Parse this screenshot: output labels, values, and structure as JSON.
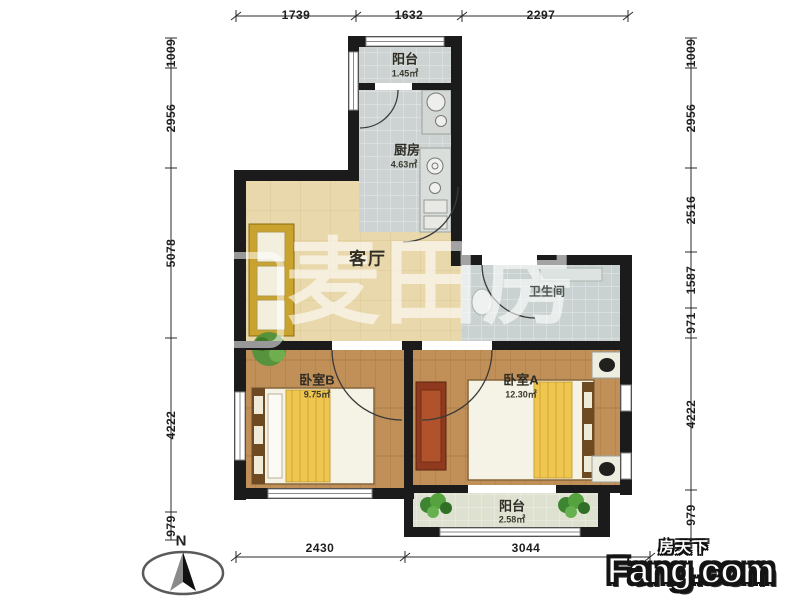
{
  "watermark": {
    "text": "麦田房"
  },
  "compass": {
    "label": "N"
  },
  "logo": {
    "cn": "房天下",
    "en": "Fang.com"
  },
  "rooms": {
    "balcony_top": {
      "name": "阳台",
      "area": "1.45㎡"
    },
    "kitchen": {
      "name": "厨房",
      "area": "4.63㎡"
    },
    "living": {
      "name": "客厅"
    },
    "bathroom": {
      "name": "卫生间"
    },
    "bedroom_b": {
      "name": "卧室B",
      "area": "9.75㎡"
    },
    "bedroom_a": {
      "name": "卧室A",
      "area": "12.30㎡"
    },
    "balcony_bottom": {
      "name": "阳台",
      "area": "2.58㎡"
    }
  },
  "dimensions": {
    "top": [
      "1739",
      "1632",
      "2297"
    ],
    "bottom": [
      "2430",
      "3044"
    ],
    "left": [
      "1009",
      "2956",
      "5078",
      "4222",
      "979"
    ],
    "right": [
      "1009",
      "2956",
      "2516",
      "1587",
      "971",
      "4222",
      "979"
    ]
  },
  "colors": {
    "wall": "#1b1b1b",
    "living_floor": "#e9d8ab",
    "wood_floor": "#c09058",
    "tile_floor": "#ccd3d2",
    "bed_blanket": "#efc64f",
    "sofa": "#caa22e",
    "plant": "#4e8f3a"
  }
}
